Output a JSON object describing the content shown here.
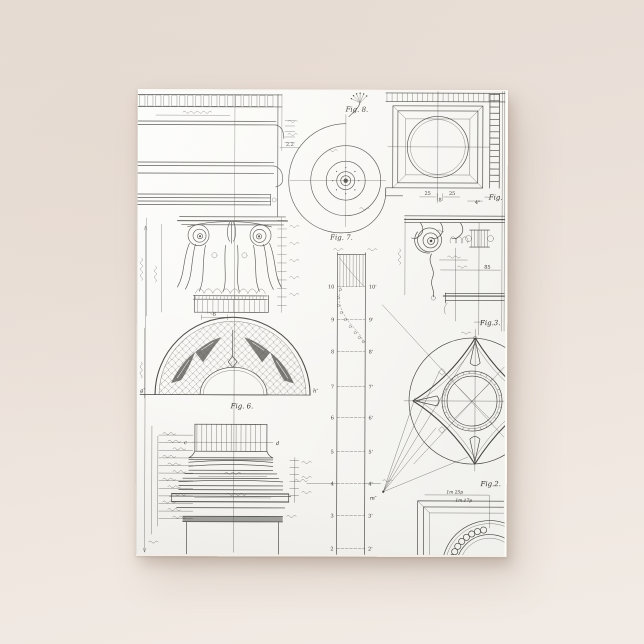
{
  "scene": {
    "setting": "product photo of a jigsaw puzzle lying on a plain warm surface",
    "background_color_top": "#e7dcd4",
    "background_color_bottom": "#f2ebe5",
    "puzzle_paper_color": "#f9f8f5",
    "ink_color": "#45443f",
    "shadow_color": "rgba(140,118,100,0.35)"
  },
  "puzzle": {
    "subject": "vintage architectural plate: classical column, capital and ornament details",
    "figure_labels": {
      "fig8": "Fig. 8.",
      "fig7": "Fig. 7.",
      "fig6": "Fig. 6.",
      "fig3": "Fig.3.",
      "fig2": "Fig.2.",
      "fig_edge_top_right": "Fig."
    },
    "shaft_scale": {
      "left": [
        "10",
        "9",
        "8",
        "7",
        "6",
        "5",
        "4",
        "3",
        "2"
      ],
      "right": [
        "10'",
        "9'",
        "8'",
        "7'",
        "6'",
        "5'",
        "4'",
        "3'",
        "2'"
      ]
    },
    "dimension_labels": {
      "coffer_left": "25",
      "coffer_center": "8",
      "coffer_right": "25",
      "coffer_inch": "4\"",
      "entablature_width": "85",
      "cornice_offset": "2.2",
      "capital_drum": "8",
      "rosette_row1": "1m 25p",
      "rosette_row2": "1m.17p"
    },
    "point_labels": {
      "arch_left": "g″",
      "arch_right": "h″",
      "fan_origin": "m″",
      "base_left": "c",
      "base_right": "d"
    }
  }
}
